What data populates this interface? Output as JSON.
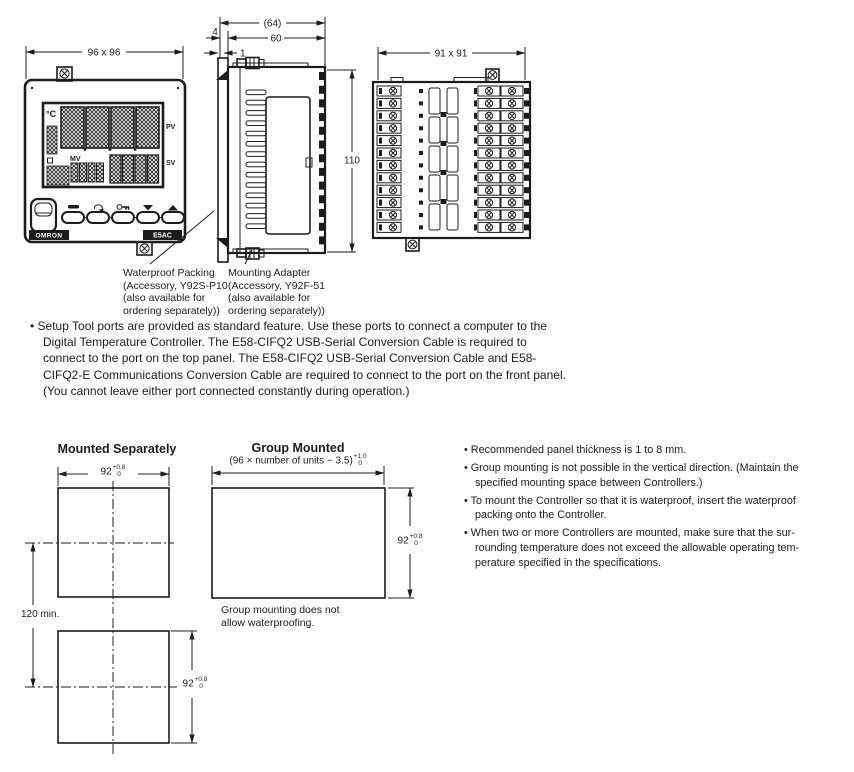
{
  "front_view": {
    "dim_label": "96 x 96",
    "display": {
      "unit": "°C",
      "pv_label": "PV",
      "sv_label": "SV",
      "mv_label": "MV"
    },
    "brand": "OMRON",
    "model": "E5AC"
  },
  "side_view": {
    "dim_overall_depth": "(64)",
    "dim_body_depth": "60",
    "dim_flange_offset": "4",
    "dim_panel_thickness": "1",
    "dim_height": "110"
  },
  "back_view": {
    "dim_label": "91 x 91"
  },
  "callouts": {
    "waterproof_packing": "Waterproof Packing\n(Accessory, Y92S-P10\n(also available for\nordering separately))",
    "mounting_adapter": "Mounting Adapter\n(Accessory, Y92F-51\n(also available for\nordering separately))"
  },
  "setup_note": "Setup Tool ports are provided as standard feature. Use these ports to connect a computer to the\nDigital Temperature Controller. The E58-CIFQ2 USB-Serial Conversion Cable is required to\nconnect to the port on the top panel. The E58-CIFQ2 USB-Serial Conversion Cable and E58-\nCIFQ2-E Communications Conversion Cable are required to connect to the port on the front panel.\n(You cannot leave either port connected constantly during operation.)",
  "cutouts": {
    "separate": {
      "title": "Mounted Separately",
      "width_value": "92",
      "width_tol_plus": "+0.8",
      "width_tol_minus": "0",
      "height_value": "92",
      "height_tol_plus": "+0.8",
      "height_tol_minus": "0",
      "spacing_label": "120 min."
    },
    "group": {
      "title": "Group Mounted",
      "width_formula": "(96 × number of units − 3.5)",
      "width_tol_plus": "+1.0",
      "width_tol_minus": "0",
      "height_value": "92",
      "height_tol_plus": "+0.8",
      "height_tol_minus": "0",
      "caption": "Group mounting does not\nallow waterproofing."
    }
  },
  "notes": {
    "items": [
      "Recommended panel thickness is 1 to 8 mm.",
      "Group mounting is not possible in the vertical direction. (Maintain the\nspecified mounting space between Controllers.)",
      "To mount the Controller so that it is waterproof, insert the waterproof\npacking onto the Controller.",
      "When two or more Controllers are mounted, make sure that the sur-\nrounding temperature does not exceed the allowable operating tem-\nperature specified in the specifications."
    ]
  }
}
